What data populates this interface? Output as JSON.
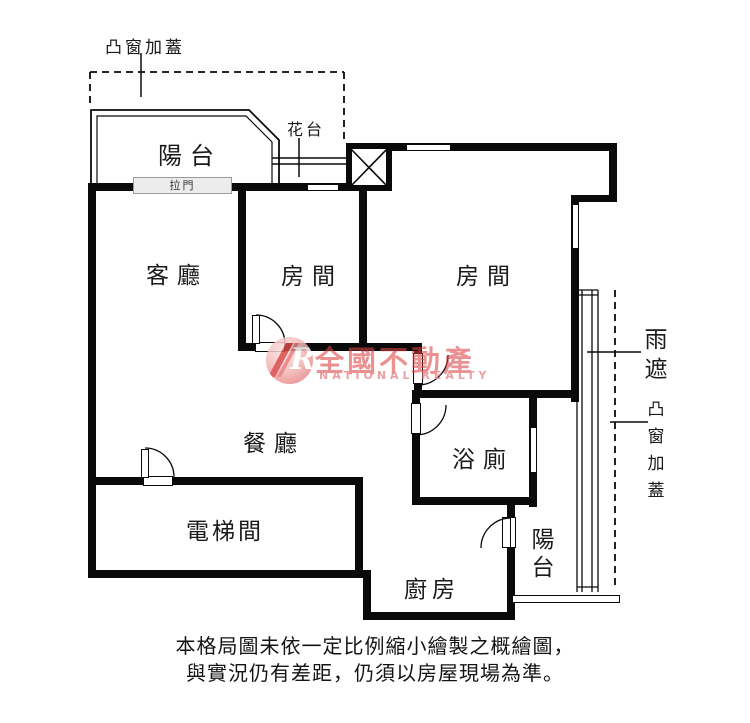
{
  "plan": {
    "rooms": {
      "balcony_top": "陽台",
      "living_room": "客廳",
      "room_1": "房間",
      "room_2": "房間",
      "dining_room": "餐廳",
      "bathroom": "浴廁",
      "elevator_room": "電梯間",
      "kitchen": "廚房",
      "balcony_bottom": "陽台"
    },
    "annotations": {
      "bay_window_cover_top": "凸窗加蓋",
      "flower_bed": "花台",
      "sliding_door": "拉門",
      "rain_shelter": "雨遮",
      "bay_window_cover_right": "凸窗加蓋"
    }
  },
  "watermark": {
    "brand": "全國不動產",
    "brand_en": "NATIONAL REALTY",
    "logo_letter": "R",
    "brand_color": "#dd4343"
  },
  "disclaimer": {
    "line1": "本格局圖未依一定比例縮小繪製之概繪圖，",
    "line2": "與實況仍有差距，仍須以房屋現場為準。"
  },
  "colors": {
    "wall": "#0a0a0a",
    "background": "#ffffff",
    "sliding_door_box": "#ececec",
    "watermark_red": "#dd4343",
    "watermark_pink": "#ec9595"
  }
}
